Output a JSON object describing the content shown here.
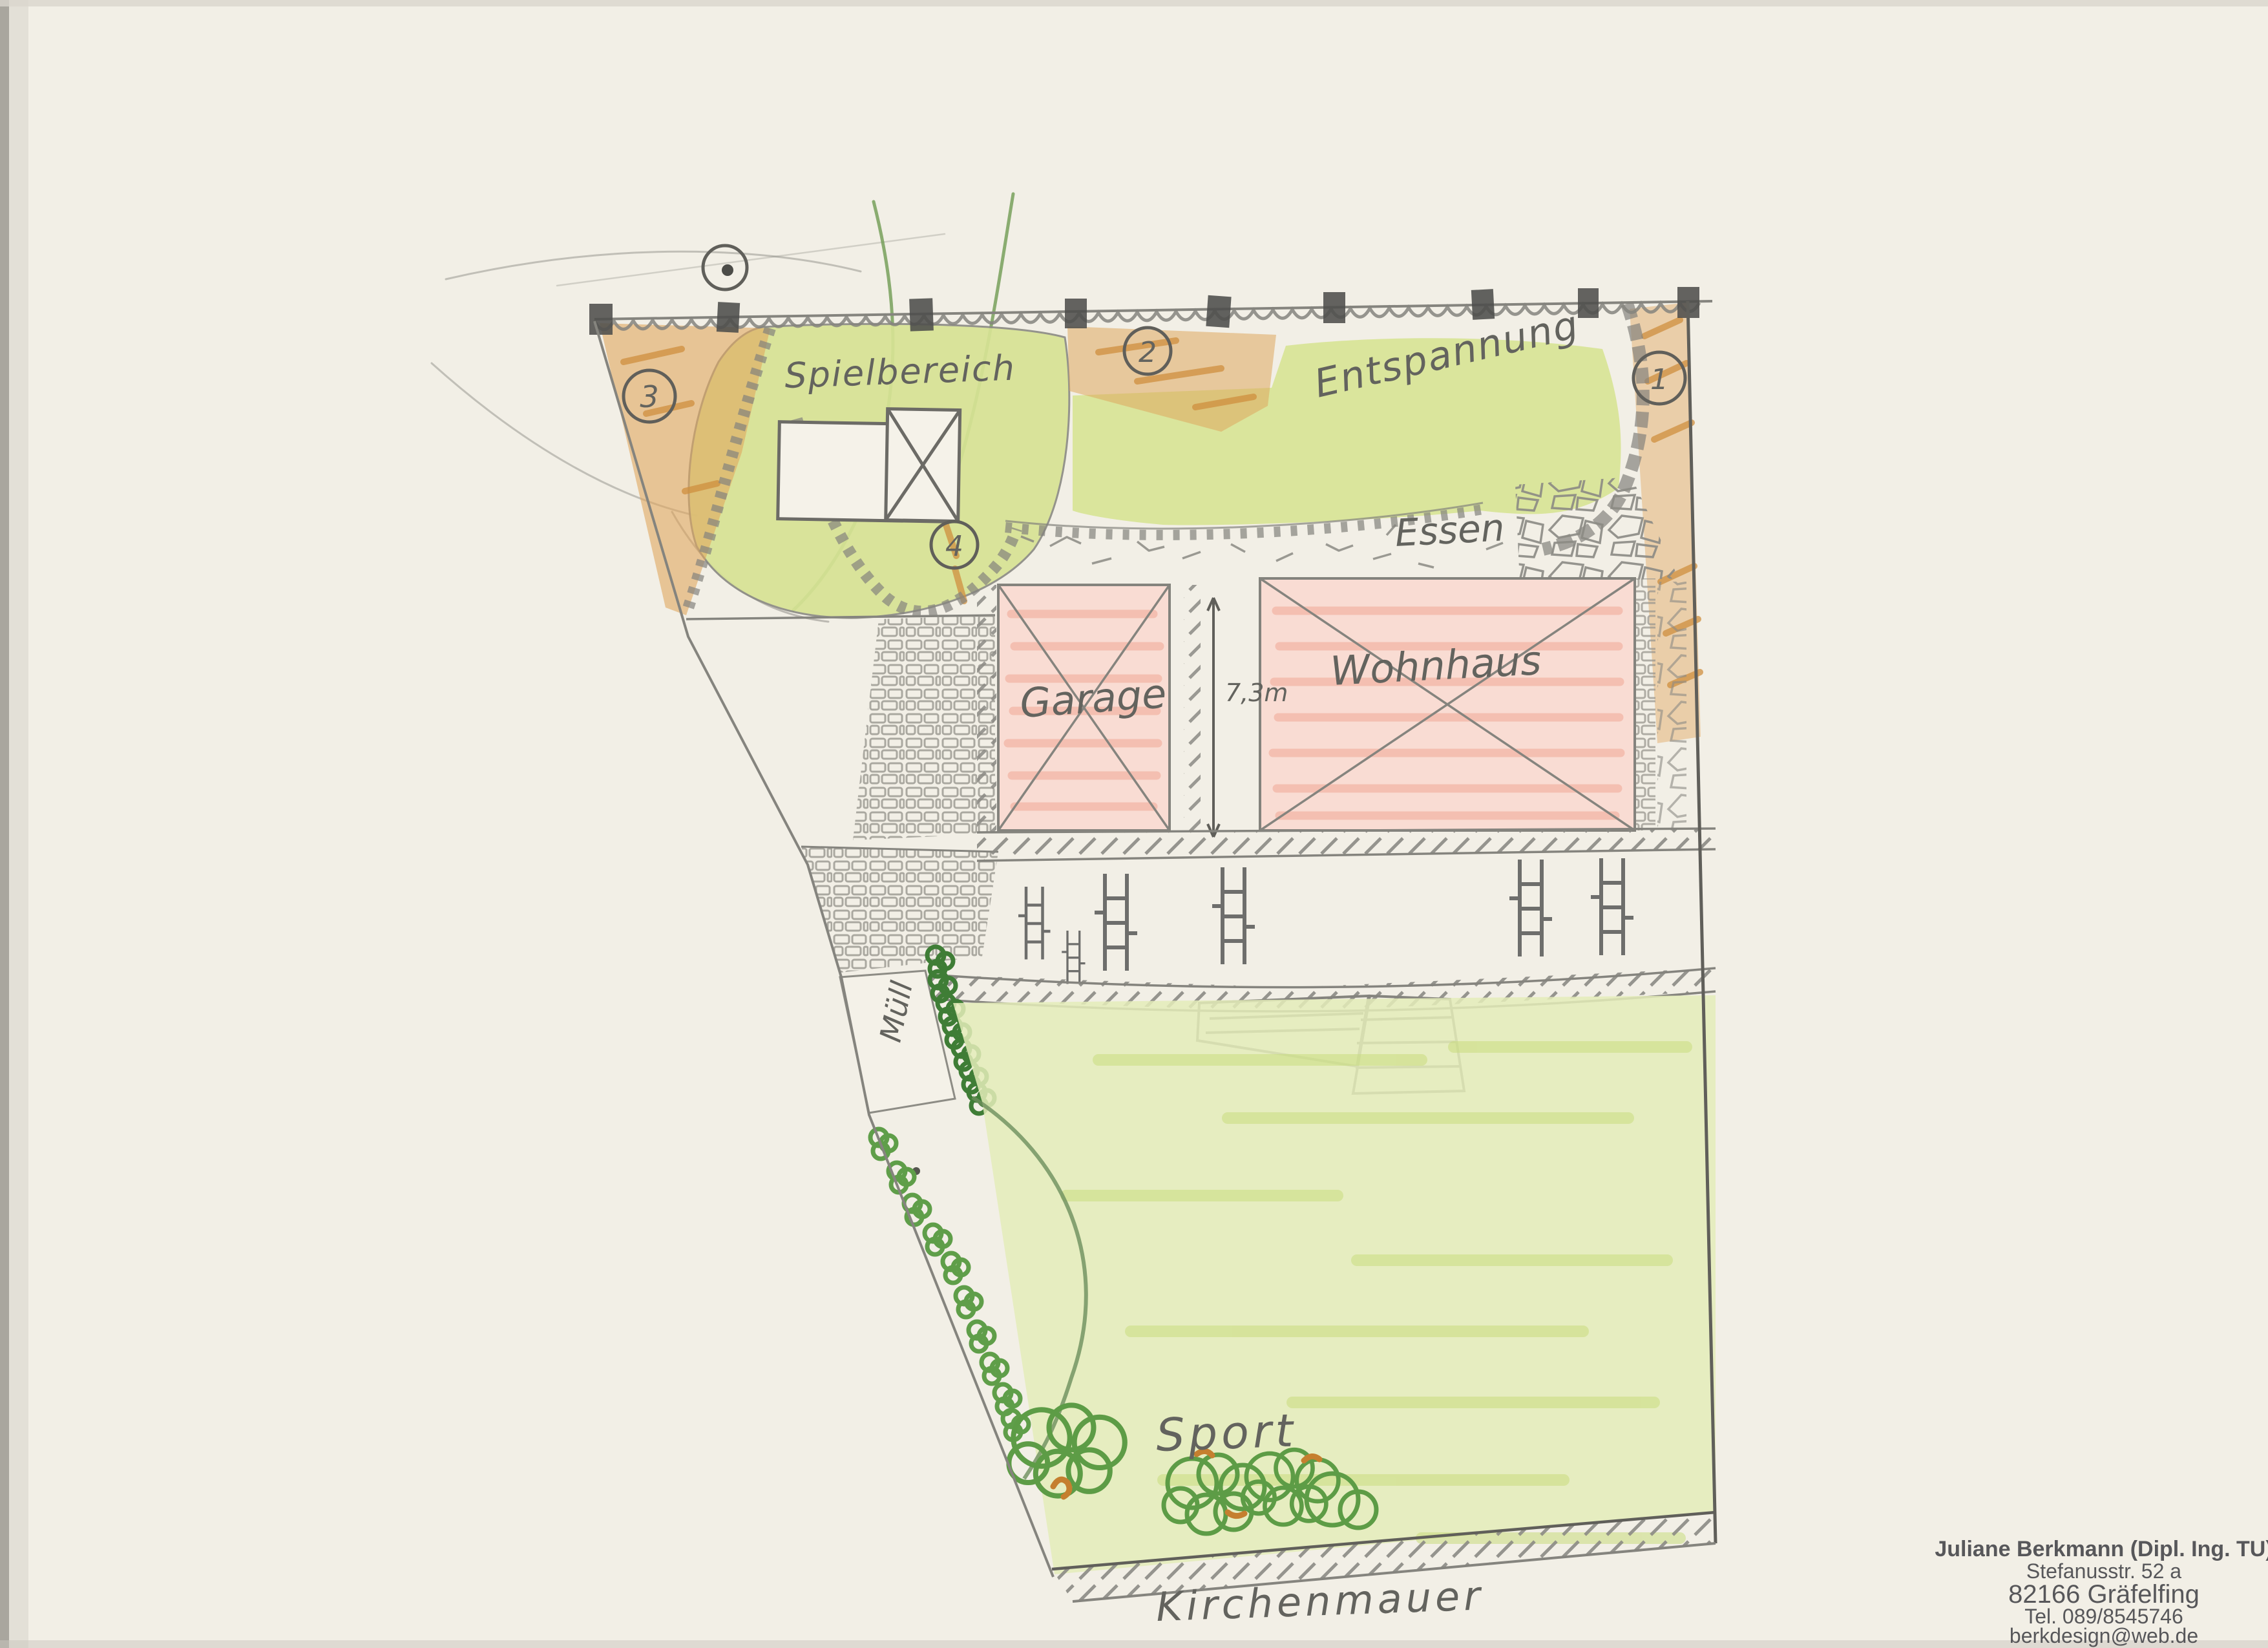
{
  "plan": {
    "labels": {
      "spielbereich": "Spielbereich",
      "entspannung": "Entspannung",
      "essen": "Essen",
      "garage": "Garage",
      "wohnhaus": "Wohnhaus",
      "dimension": "7,3m",
      "muell": "Müll",
      "sport": "Sport",
      "kirchenmauer": "Kirchenmauer"
    },
    "markers": [
      {
        "n": "1"
      },
      {
        "n": "2"
      },
      {
        "n": "3"
      },
      {
        "n": "4"
      }
    ],
    "symbols": {
      "north": "circle-dot"
    },
    "colors": {
      "paper": "#f2efe6",
      "lawn": "#d7e394",
      "lawn_pale": "#e4ecb8",
      "mulch": "#dfa75f",
      "mulch_deep": "#cf8f3f",
      "building": "#f9dcd3",
      "building_hatch": "#f0a391",
      "pencil": "#85847e",
      "green_pencil": "#5f9e49",
      "green_dark": "#3f7d36",
      "stamp_ink": "#47474b"
    }
  },
  "stamp": {
    "line1": "Juliane Berkmann (Dipl. Ing. TU)",
    "line2": "Stefanusstr. 52 a",
    "line3": "82166 Gräfelfing",
    "line4": "Tel. 089/8545746",
    "line5": "berkdesign@web.de"
  }
}
